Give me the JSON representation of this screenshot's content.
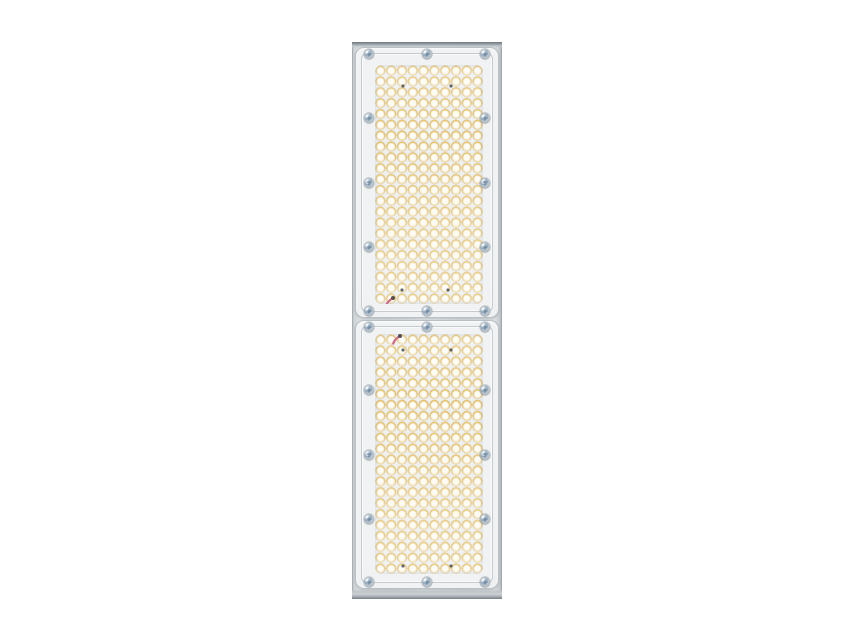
{
  "scene": {
    "type": "product-photo",
    "subject": "Linear industrial LED luminaire, front view, two optic modules on white background",
    "background_color": "#ffffff"
  },
  "fixture": {
    "colors": {
      "frame": "#dbdfe1",
      "edge": "#979ea3",
      "plate": "#f0f2f3",
      "plate_border": "#b9c0c5",
      "led_ring": "#ecc262",
      "led_center": "#fbfaf5",
      "screw_head": "#8aa2b8",
      "screw_slot": "#5f7d97",
      "wire": "#d06b85",
      "wire_tip": "#564c55"
    },
    "screw_cols": [
      0.09,
      0.5,
      0.91
    ],
    "screw_rows": [
      0.022,
      0.26,
      0.5,
      0.74,
      0.978
    ],
    "modules": [
      {
        "name": "optic-module-top",
        "led_rows": 22,
        "led_cols": 10,
        "board_dots": [
          [
            0.26,
            0.088
          ],
          [
            0.7,
            0.088
          ],
          [
            0.25,
            0.94
          ],
          [
            0.68,
            0.94
          ]
        ],
        "wire": {
          "x": 0.13,
          "y": 0.985
        }
      },
      {
        "name": "optic-module-bottom",
        "led_rows": 22,
        "led_cols": 10,
        "board_dots": [
          [
            0.26,
            0.067
          ],
          [
            0.7,
            0.067
          ],
          [
            0.26,
            0.965
          ],
          [
            0.7,
            0.965
          ]
        ],
        "wire": {
          "x": 0.19,
          "y": 0.015
        }
      }
    ]
  }
}
